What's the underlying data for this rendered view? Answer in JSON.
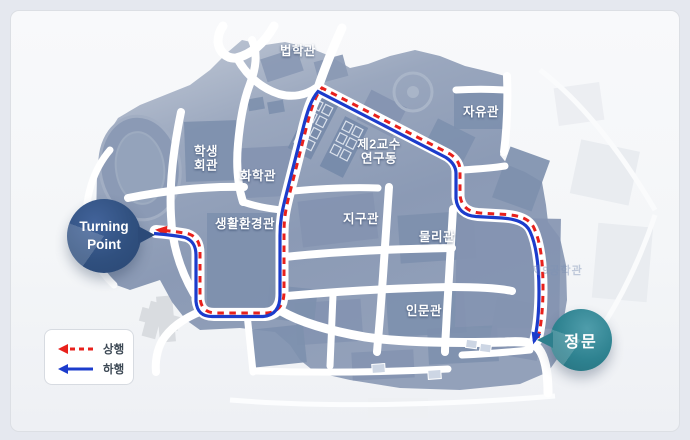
{
  "page": {
    "background": "#e5e8ef",
    "panel_background": "#f5f7f9",
    "panel_border": "#dcdfe4"
  },
  "map": {
    "land_color": "#8b9ab5",
    "building_color": "#7e90ae",
    "road_color": "#ffffff",
    "labels": [
      {
        "id": "beophakgwan",
        "text": "법학관",
        "lines": [
          "법학관"
        ]
      },
      {
        "id": "jayugwan",
        "text": "자유관",
        "lines": [
          "자유관"
        ]
      },
      {
        "id": "haksaeng-hoegwan",
        "text": "학생회관",
        "lines": [
          "학생",
          "회관"
        ]
      },
      {
        "id": "hwahakgwan",
        "text": "화학관",
        "lines": [
          "화학관"
        ]
      },
      {
        "id": "je2gyosu-yeongudong",
        "text": "제2교수연구동",
        "lines": [
          "제2교수",
          "연구동"
        ]
      },
      {
        "id": "saenghwal-hwangyeonggwan",
        "text": "생활환경관",
        "lines": [
          "생활환경관"
        ]
      },
      {
        "id": "jigugwan",
        "text": "지구관",
        "lines": [
          "지구관"
        ]
      },
      {
        "id": "mulligwan",
        "text": "물리관",
        "lines": [
          "물리관"
        ]
      },
      {
        "id": "inmungwan",
        "text": "인문관",
        "lines": [
          "인문관"
        ]
      }
    ],
    "ghost_label": {
      "text": "제9공학관"
    }
  },
  "route": {
    "path": "M 538 338 C 541 327 543 308 543 288 C 543 264 541 243 534 228 C 530 219 520 215.5 506 214.5 L 480 213 C 468 212 461 206 460 195 L 460 170 C 460 163 456 158 450 154 L 322 88 C 315 96 311 109 307 125 L 289 196 C 286 208 284 218 284 232 L 284 292 C 284 304 279 312 267 313 L 216 313 C 206 313 201 308 200 298 L 200 252 C 200 243 197 237 189 234 C 180 232 170 231 158 230",
    "up": {
      "label": "상행",
      "color": "#e8211c",
      "style": "dashed"
    },
    "down": {
      "label": "하행",
      "color": "#1c3ccc",
      "style": "solid"
    }
  },
  "badges": {
    "turning_point": {
      "lines": [
        "Turning",
        "Point"
      ],
      "color": "#30507f"
    },
    "main_gate": {
      "text": "정문",
      "color": "#2e8290"
    }
  },
  "legend": {
    "items": [
      {
        "label": "상행",
        "color": "#e8211c",
        "style": "dashed"
      },
      {
        "label": "하행",
        "color": "#1c3ccc",
        "style": "solid"
      }
    ]
  }
}
